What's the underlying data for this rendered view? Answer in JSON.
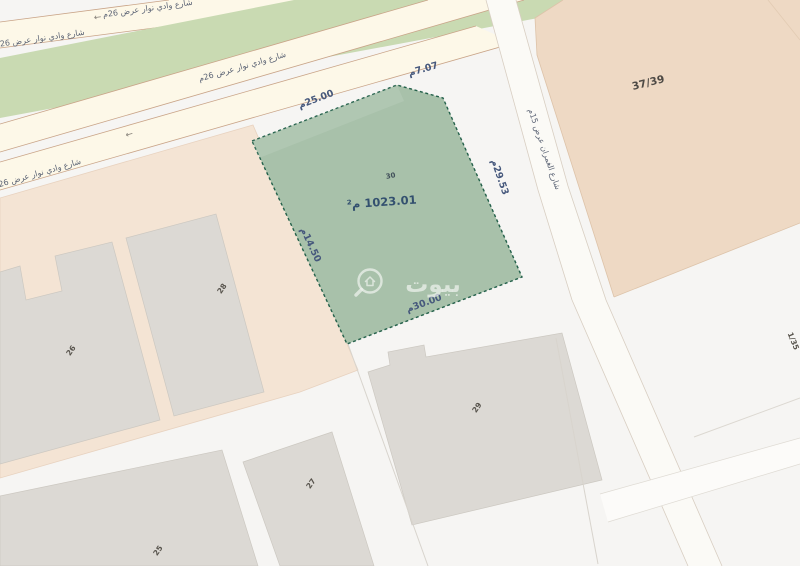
{
  "map": {
    "watermark": {
      "brand": "بيوت"
    },
    "subject_parcel": {
      "number": "30",
      "area_label": "1023.01 م²",
      "dimensions": {
        "top": "25.00م",
        "corner": "7.07م",
        "right": "29.53م",
        "left": "14.50م",
        "bottom": "30.00م"
      }
    },
    "streets": {
      "main_road_label": "شارع وادي نوار عرض 26م",
      "side_street_label": "شارع الغمران عرض 15م",
      "direction_arrow": "←"
    },
    "adjacent_parcels": {
      "top_right": "37/39",
      "left_upper": "28",
      "left_lower": "26",
      "bottom_center": "29",
      "bottom_inner": "27",
      "bottom_left": "25",
      "right_lower": "1/35"
    },
    "colors": {
      "subject_fill": "#a8c1aa",
      "subject_border": "#23604a",
      "street_fill": "#fdf8e8",
      "median_fill": "#c9dab2",
      "parcel_tan": "#eed9c4",
      "parcel_peach": "#f4e4d4",
      "building_gray": "#dcd9d4"
    }
  }
}
